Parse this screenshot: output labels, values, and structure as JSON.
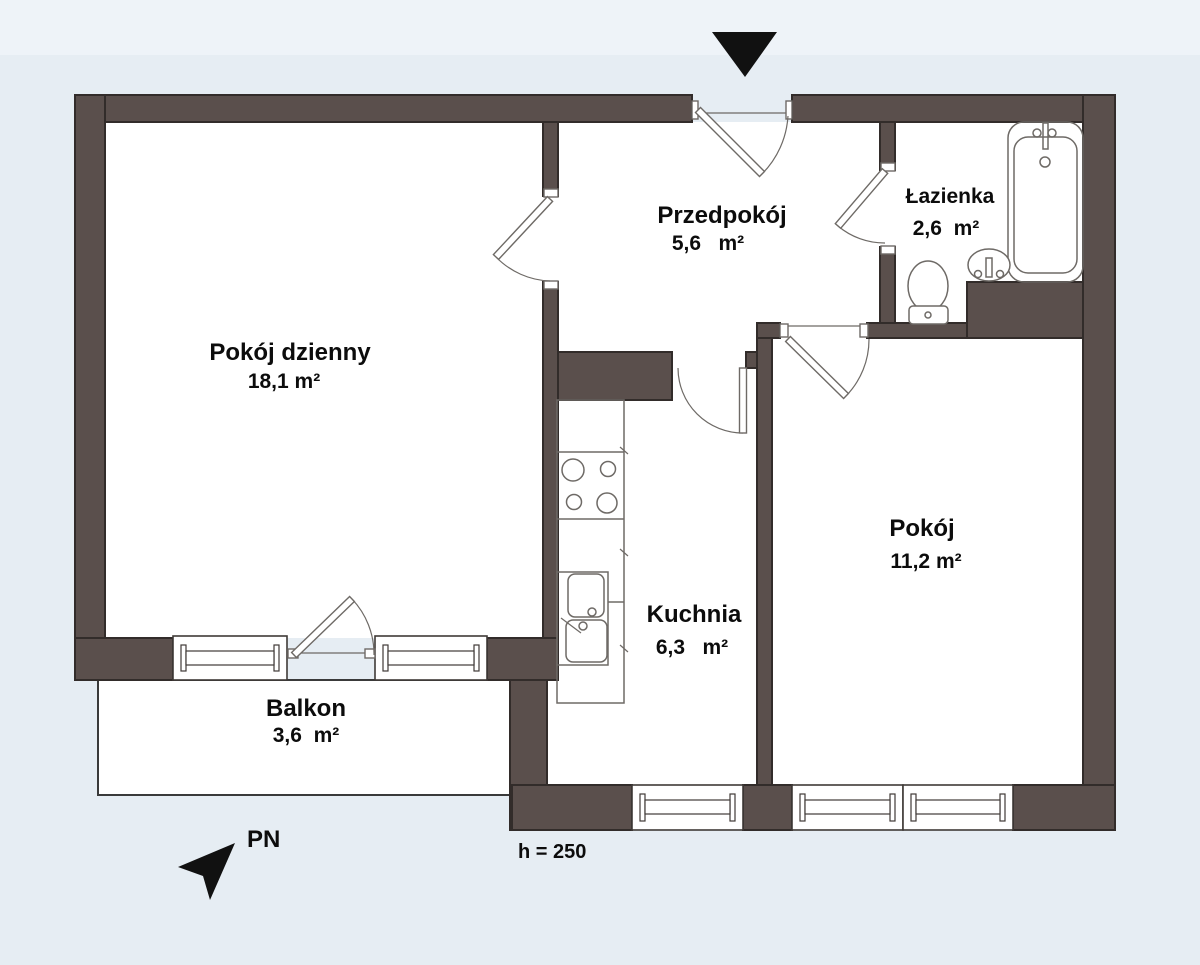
{
  "colors": {
    "wall": "#5a4f4c",
    "outline": "#322c2a",
    "background": "#e6edf3",
    "background_top": "#eef3f8",
    "line": "#6e6a66",
    "win_line": "#3f3a37",
    "text": "#0c0c0c",
    "black": "#111111"
  },
  "rooms": [
    {
      "id": "pokoj-dzienny",
      "name": "Pokój dzienny",
      "area": "18,1 m²"
    },
    {
      "id": "przedpokoj",
      "name": "Przedpokój",
      "area": "5,6   m²"
    },
    {
      "id": "lazienka",
      "name": "Łazienka",
      "area": "2,6  m²"
    },
    {
      "id": "kuchnia",
      "name": "Kuchnia",
      "area": "6,3   m²"
    },
    {
      "id": "pokoj",
      "name": "Pokój",
      "area": "11,2 m²"
    },
    {
      "id": "balkon",
      "name": "Balkon",
      "area": "3,6  m²"
    }
  ],
  "annotations": {
    "ceiling_height_label": "h = 250",
    "north_label": "PN"
  },
  "icons": {
    "entrance_arrow": "solid triangle pointing down at main entrance",
    "north_arrow": "black dart pointing up-right"
  }
}
